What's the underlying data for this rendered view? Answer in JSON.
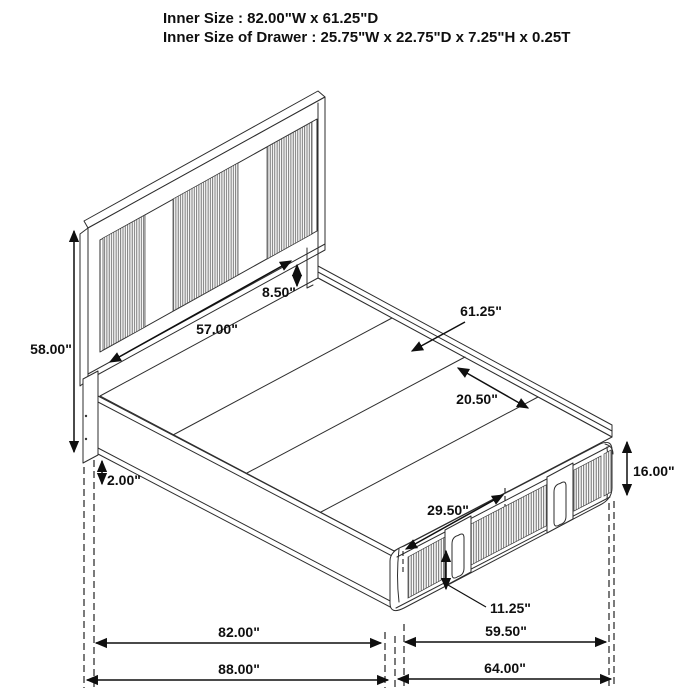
{
  "title": {
    "line1": "Inner Size : 82.00\"W x 61.25\"D",
    "line2": "Inner Size of Drawer : 25.75\"W x 22.75\"D x 7.25\"H x 0.25T"
  },
  "dimensions": {
    "headboard_height": "58.00\"",
    "headboard_panel_width": "57.00\"",
    "headboard_rail_height": "8.50\"",
    "platform_inner_depth": "61.25\"",
    "slat_spacing": "20.50\"",
    "drawer_opening_width": "29.50\"",
    "drawer_front_height": "11.25\"",
    "footboard_height": "16.00\"",
    "floor_clearance": "2.00\"",
    "platform_length": "82.00\"",
    "footboard_inner_width": "59.50\"",
    "overall_length": "88.00\"",
    "overall_width": "64.00\""
  },
  "colors": {
    "line": "#2e2e2e",
    "dimension": "#0f0f0f",
    "rib_line": "#5f5f5f",
    "background": "#ffffff"
  }
}
